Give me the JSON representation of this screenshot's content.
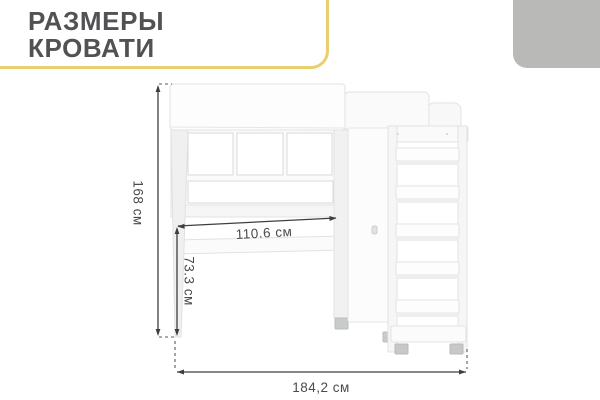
{
  "header": {
    "title_line1": "РАЗМЕРЫ",
    "title_line2": "КРОВАТИ",
    "accent_yellow": "#e9cf72",
    "corner_gray": "#b9b9b8"
  },
  "diagram": {
    "type": "furniture-dimension-diagram",
    "subject": "loft bed with desk, wardrobe and shelf-ladder",
    "dimensions": {
      "height": "168 см",
      "desk_width": "110.6 см",
      "desk_height": "73.3 см",
      "total_width": "184,2 см"
    },
    "line_color": "#3e3e3e",
    "label_color": "#4b4b4b",
    "furniture_fill": "#fcfcfc",
    "furniture_outline": "#e3e3e3"
  }
}
